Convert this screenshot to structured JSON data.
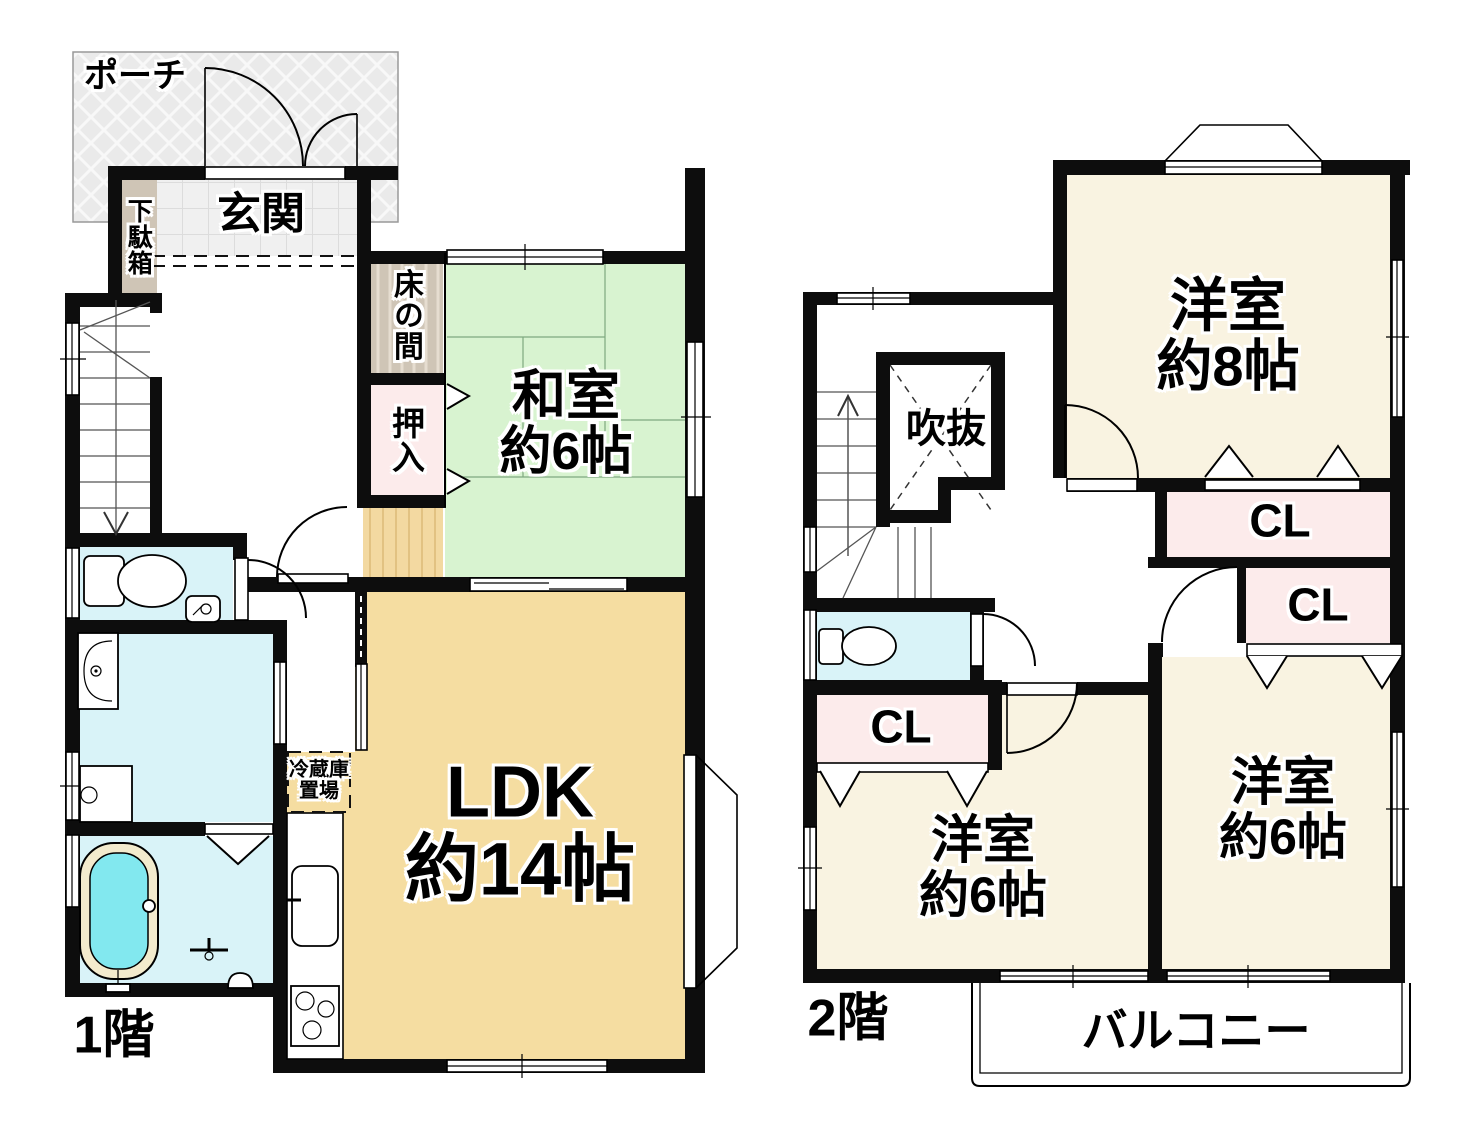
{
  "colors": {
    "wall": "#0d0d0d",
    "tatami_green": "#d8f3d0",
    "room_cream": "#f9f3e1",
    "ldk_tan": "#f5dda1",
    "closet_pink": "#fcebeb",
    "water_cyan": "#d9f3f8",
    "tub_water": "#82e8ef",
    "tub_rim": "#f3ebcd",
    "beige": "#cfc5b6",
    "wood_tan": "#f3d9a1",
    "porch_gray": "#eaeaea"
  },
  "floor1": {
    "label": "1階",
    "porch": "ポーチ",
    "entrance": "玄関",
    "shoe_cabinet": "下駄箱",
    "tokonoma": "床の間",
    "oshiire": "押入",
    "japanese_room": {
      "name": "和室",
      "size": "約6帖"
    },
    "ldk": {
      "name": "LDK",
      "size": "約14帖"
    },
    "fridge_space": {
      "line1": "冷蔵庫",
      "line2": "置場"
    }
  },
  "floor2": {
    "label": "2階",
    "atrium": "吹抜",
    "room8": {
      "name": "洋室",
      "size": "約8帖"
    },
    "room6_left": {
      "name": "洋室",
      "size": "約6帖"
    },
    "room6_right": {
      "name": "洋室",
      "size": "約6帖"
    },
    "closets": [
      "CL",
      "CL",
      "CL"
    ],
    "balcony": "バルコニー"
  }
}
